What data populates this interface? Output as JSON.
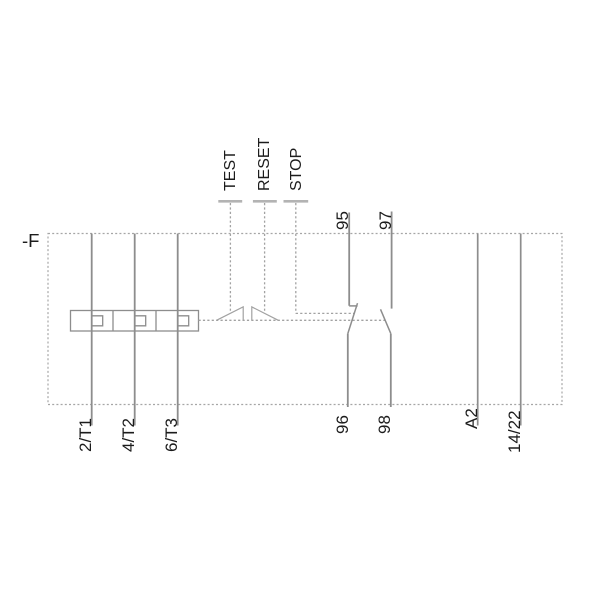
{
  "device": {
    "label": "-F"
  },
  "controls": {
    "test": "TEST",
    "reset": "RESET",
    "stop": "STOP"
  },
  "terminals": {
    "main_circuit": [
      "2/T1",
      "4/T2",
      "6/T3"
    ],
    "nc_contact": {
      "top": "95",
      "bottom": "96"
    },
    "no_contact": {
      "top": "97",
      "bottom": "98"
    },
    "coil": "A2",
    "aux": "14/22"
  },
  "colors": {
    "background": "#ffffff",
    "line": "#8d8d8d",
    "dashed_line": "#a2a2a2",
    "tick": "#b3b3b3",
    "text": "#1c1c1c"
  }
}
